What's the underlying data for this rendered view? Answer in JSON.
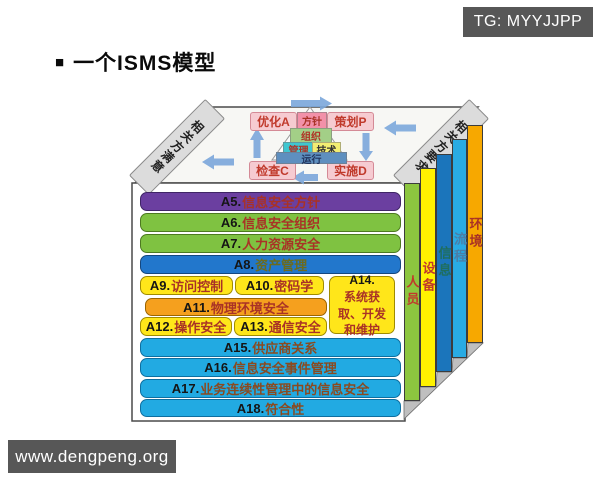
{
  "watermark_top": "TG: MYYJJPP",
  "watermark_bottom": "www.dengpeng.org",
  "title": {
    "bullet": "■",
    "text": "一个ISMS模型"
  },
  "top_face": {
    "left_band": "相关方满意",
    "right_band": "相关方要求",
    "pdca": {
      "act": "优化A",
      "plan": "策划P",
      "check": "检查C",
      "do": "实施D"
    },
    "pyramid": {
      "layers": [
        "方针",
        "组织",
        "管理",
        "技术",
        "运行"
      ]
    }
  },
  "front_face": {
    "controls": [
      {
        "code": "A5.",
        "label": "信息安全方针"
      },
      {
        "code": "A6.",
        "label": "信息安全组织"
      },
      {
        "code": "A7.",
        "label": "人力资源安全"
      },
      {
        "code": "A8.",
        "label": "资产管理"
      },
      {
        "code": "A9.",
        "label": "访问控制"
      },
      {
        "code": "A10.",
        "label": "密码学"
      },
      {
        "code": "A11.",
        "label": "物理环境安全"
      },
      {
        "code": "A12.",
        "label": "操作安全"
      },
      {
        "code": "A13.",
        "label": "通信安全"
      },
      {
        "code": "A14.",
        "label": "系统获取、开发和维护"
      },
      {
        "code": "A15.",
        "label": "供应商关系"
      },
      {
        "code": "A16.",
        "label": "信息安全事件管理"
      },
      {
        "code": "A17.",
        "label": "业务连续性管理中的信息安全"
      },
      {
        "code": "A18.",
        "label": "符合性"
      }
    ]
  },
  "side_panels": [
    {
      "label": "人员"
    },
    {
      "label": "设备"
    },
    {
      "label": "信息"
    },
    {
      "label": "流程"
    },
    {
      "label": "环境"
    }
  ],
  "colors": {
    "bar_purple": "#6B3FA0",
    "bar_green": "#7FC241",
    "bar_blue": "#2277CC",
    "bar_yellow": "#FFE61A",
    "bar_orange": "#F5A01E",
    "bar_cyan": "#22AAE2",
    "panel_green": "#8CC63F",
    "panel_yellow": "#FFF200",
    "panel_darkblue": "#1B75BB",
    "panel_lightblue": "#29ABE3",
    "panel_orange": "#F7A800",
    "pdca_pink": "#F6CBD1",
    "arrow_blue": "#7BA7DB",
    "band_gray": "#DCDCDC",
    "watermark_gray": "#575757",
    "label_red": "#A93226"
  }
}
